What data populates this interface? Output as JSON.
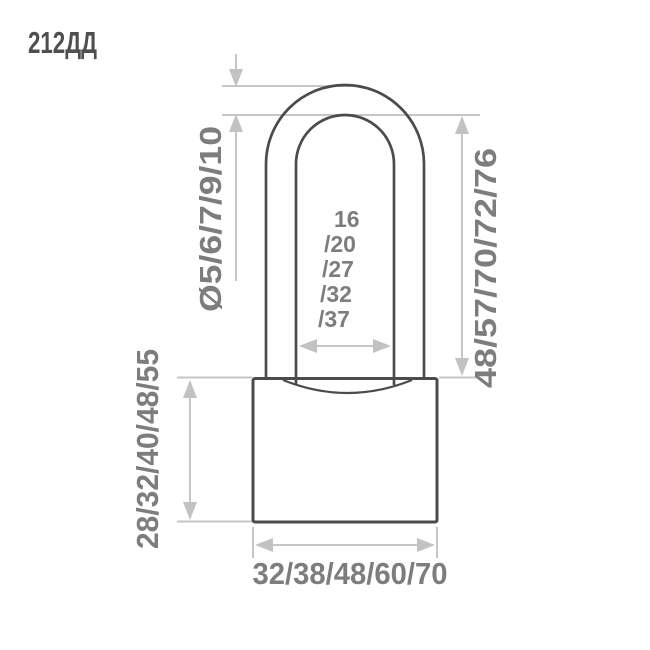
{
  "title": "212ДД",
  "colors": {
    "outline": "#4b4b4b",
    "dimension_lines": "#c6c6c6",
    "label_text": "#7d7d7d",
    "title_text": "#4f4f4f",
    "background": "#ffffff"
  },
  "drawing": {
    "subject": "padlock with long shackle, dimensioned engineering drawing"
  },
  "dimensions": {
    "shackle_diameter": {
      "label": "Ø5/6/7/9/10",
      "values": [
        5,
        6,
        7,
        9,
        10
      ]
    },
    "shackle_height": {
      "label": "48/57/70/72/76",
      "values": [
        48,
        57,
        70,
        72,
        76
      ]
    },
    "body_height": {
      "label": "28/32/40/48/55",
      "values": [
        28,
        32,
        40,
        48,
        55
      ]
    },
    "body_width": {
      "label": "32/38/48/60/70",
      "values": [
        32,
        38,
        48,
        60,
        70
      ]
    },
    "shackle_inner_width": {
      "values": [
        16,
        20,
        27,
        32,
        37
      ],
      "rows": [
        "16",
        "/20",
        "/27",
        "/32",
        "/37"
      ]
    }
  }
}
